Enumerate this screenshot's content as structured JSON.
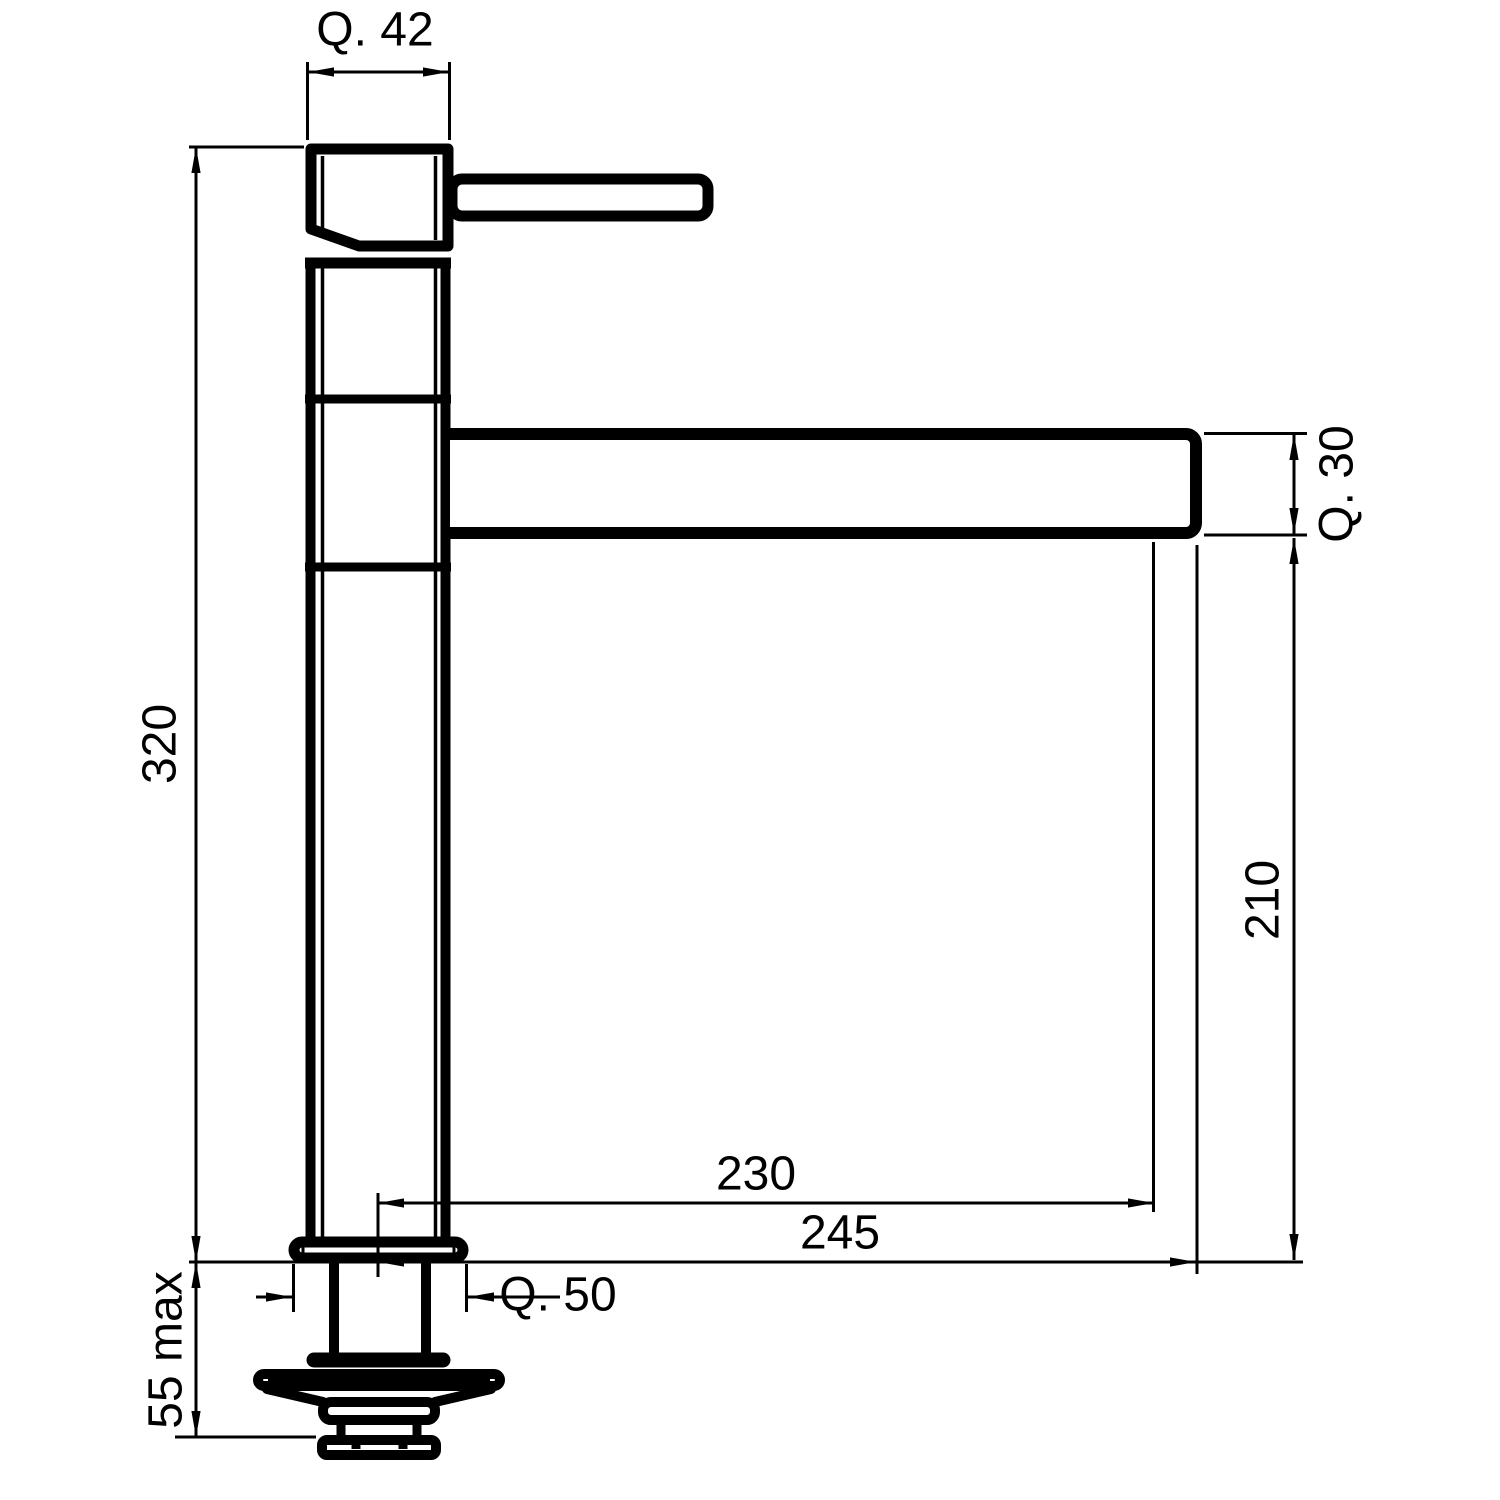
{
  "drawing": {
    "colors": {
      "line": "#000000",
      "background": "#ffffff"
    },
    "dimensions": {
      "head_width": "Q. 42",
      "overall_height": "320",
      "spout_section": "Q. 30",
      "spout_underside_height": "210",
      "reach_to_outlet": "230",
      "overall_reach": "245",
      "base_width": "Q. 50",
      "max_deck_thickness": "55 max"
    }
  }
}
